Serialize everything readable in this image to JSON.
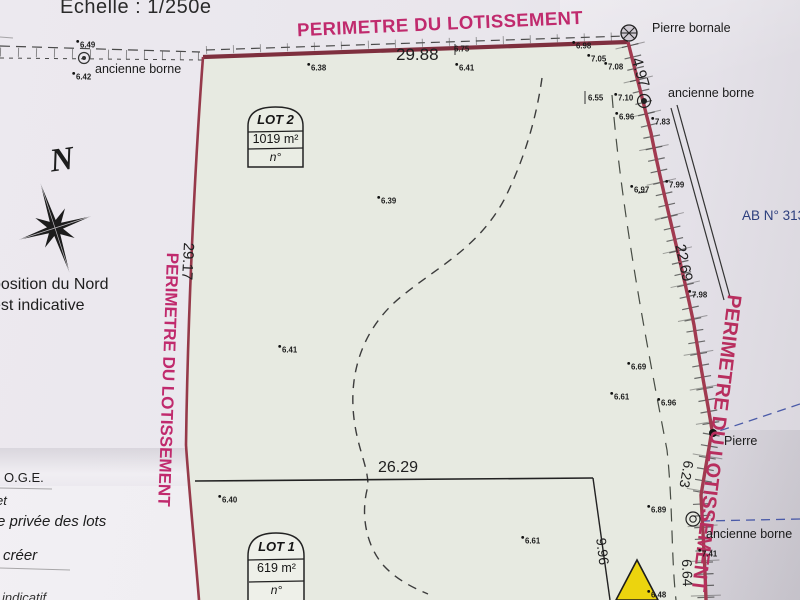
{
  "scale_label": "Echelle : 1/250e",
  "perimeter": {
    "top": "PERIMETRE DU LOTISSEMENT",
    "left": "PERIMETRE DU LOTISSEMENT",
    "right": "PERIMETRE DU LOTISSEMENT"
  },
  "landmarks": {
    "pierre_bornale": "Pierre bornale",
    "ancienne_borne_left": "ancienne borne",
    "ancienne_borne_right": "ancienne borne",
    "ancienne_borne_bottom": "ancienne borne",
    "pierre": "Pierre",
    "parcel_ref": "AB N° 313"
  },
  "north": {
    "letter": "N",
    "note_line1": "position du Nord",
    "note_line2": "est indicative"
  },
  "side_notes": {
    "oge": "O.G.E.",
    "fragment_et": "et",
    "private_road": "e privée des lots",
    "creer": "créer",
    "indicatif": "indicatif"
  },
  "lots": [
    {
      "name": "LOT 2",
      "area": "1019 m²",
      "number_label": "n°"
    },
    {
      "name": "LOT 1",
      "area": "619  m²",
      "number_label": "n°"
    }
  ],
  "dimensions": {
    "top": "29.88",
    "left": "29.17",
    "middle": "26.29",
    "upper_right": "4.97",
    "right": "22.69",
    "lower_right_1": "6.23",
    "lower_right_2": "6.64",
    "lot1_right": "9.96"
  },
  "colors": {
    "boundary_red": "#9c3a4c",
    "perimeter_magenta": "#c02a6d",
    "parcel_ref_blue": "#2c3e7d",
    "triangle_yellow": "#ecd40e"
  },
  "elevations": [
    {
      "v": "6.49"
    },
    {
      "v": "6.42"
    },
    {
      "v": "6.38"
    },
    {
      "v": "6.75"
    },
    {
      "v": "6.41"
    },
    {
      "v": "6.98"
    },
    {
      "v": "7.05"
    },
    {
      "v": "7.08"
    },
    {
      "v": "6.55"
    },
    {
      "v": "7.10"
    },
    {
      "v": "6.96"
    },
    {
      "v": "7.83"
    },
    {
      "v": "6.97"
    },
    {
      "v": "7.99"
    },
    {
      "v": "7.98"
    },
    {
      "v": "6.39"
    },
    {
      "v": "6.41"
    },
    {
      "v": "6.69"
    },
    {
      "v": "6.61"
    },
    {
      "v": "6.96"
    },
    {
      "v": "6.40"
    },
    {
      "v": "6.89"
    },
    {
      "v": "6.61"
    },
    {
      "v": "7.41"
    },
    {
      "v": "6.48"
    }
  ]
}
